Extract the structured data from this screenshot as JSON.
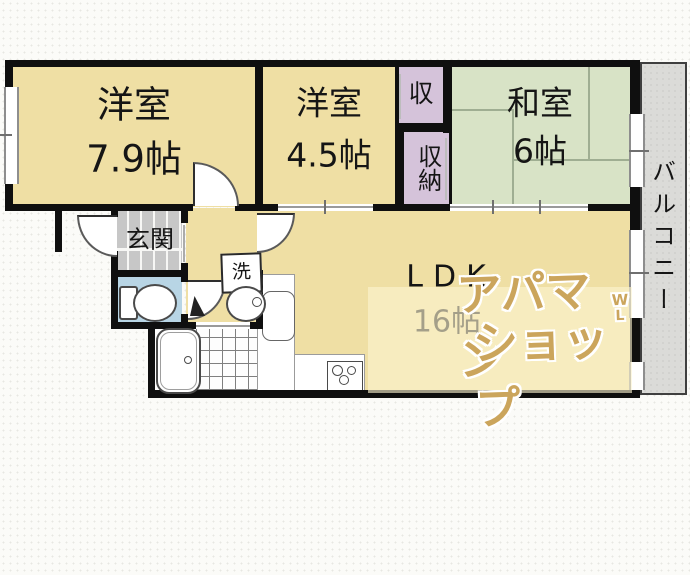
{
  "plan": {
    "rooms": {
      "west1": {
        "name": "洋室",
        "size": "7.9帖"
      },
      "west2": {
        "name": "洋室",
        "size": "4.5帖"
      },
      "japanese": {
        "name": "和室",
        "size": "6帖"
      },
      "ldk": {
        "name": "LDK",
        "size": "16帖"
      },
      "closet_upper": "収",
      "closet_lower": "収納",
      "entrance": "玄関",
      "laundry": "洗",
      "balcony": "バルコニー"
    },
    "watermark": {
      "line1": "アパマン",
      "line2": "ショップ",
      "mark_top": "W",
      "mark_bottom": "L"
    },
    "colors": {
      "room_beige": "#EFDFA4",
      "tatami_green": "#D8E3C6",
      "closet_purple": "#D5C3DA",
      "toilet_blue": "#B8D5E5",
      "entrance_gray": "#C7C7C7",
      "balcony_gray": "#DBDBD8",
      "wall_black": "#0F0F0F",
      "watermark_tan": "#CBA55C"
    }
  }
}
